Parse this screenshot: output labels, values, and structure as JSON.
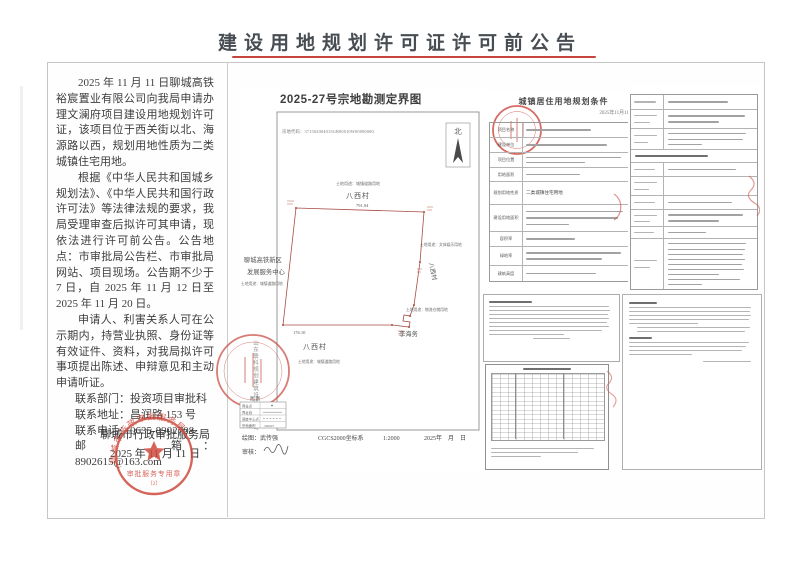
{
  "page": {
    "title": "建设用地规划许可证许可前公告"
  },
  "announcement": {
    "paragraphs": [
      "2025 年 11 月 11 日聊城高铁裕宸置业有限公司向我局申请办理文澜府项目建设用地规划许可证，该项目位于西关街以北、海源路以西，规划用地性质为二类城镇住宅用地。",
      "根据《中华人民共和国城乡规划法》、《中华人民共和国行政许可法》等法律法规的要求，我局受理审查后拟许可其申请，现依法进行许可前公告。公告地点：市审批局公告栏、市审批局网站、项目现场。公告期不少于 7 日，自 2025 年 11 月 12 日至 2025 年 11 月 20 日。",
      "申请人、利害关系人可在公示期内，持营业执照、身份证等有效证件、资料，对我局拟许可事项提出陈述、申辩意见和主动申请听证。"
    ],
    "contact": [
      "联系部门：投资项目审批科",
      "联系地址：昌润路 153 号",
      "联系电话：0635-8902708",
      "邮　　箱：8902615@163.com"
    ],
    "signoff": {
      "org": "聊城市行政审批服务局",
      "date": "2025 年 11 月 11 日"
    },
    "seal": {
      "arc": "聊城市行政审批服务局",
      "label": "审批服务专用章",
      "number": "（2）"
    }
  },
  "survey_map": {
    "title": "2025-27号宗地勘测定界图",
    "parcel_code": "宗地代码：371502004015GB00010W00000000",
    "north": "北",
    "labels": {
      "landuse_north": "土地用途：城镇道路用地",
      "village_north": "八西村",
      "edge_north": "791.04",
      "org_west_1": "聊城高铁新区",
      "org_west_2": "发展服务中心",
      "landuse_west": "土地用途：城镇道路用地",
      "landuse_east": "土地用途：文体娱乐用地",
      "village_east": "八西村",
      "landuse_southeast": "土地用途：物流仓储用地",
      "neighbor_southeast": "李海务",
      "edge_south": "176.10",
      "village_south": "八西村",
      "landuse_south": "土地用途：城镇道路用地"
    },
    "legend": {
      "title": "图 例",
      "row1": "界址点",
      "row2": "界址线",
      "row3": "调查中心点",
      "row4": "宗地面积",
      "row4_value": "320647"
    },
    "surveyor": "山东联科规划建筑设计有限公司",
    "footer": {
      "drawn_by": "绘图：武传强",
      "crs": "CGCS2000坐标系",
      "scale": "1:2000",
      "date": "2025年　月　日",
      "checked_by": "审核："
    }
  },
  "conditions_doc": {
    "title": "城镇居住用地规划条件",
    "date": "2025年11月11日",
    "rows": [
      {
        "label": "项目名称"
      },
      {
        "label": "建设单位"
      },
      {
        "label": "项目位置"
      },
      {
        "label": "用地面积"
      },
      {
        "label": "规划用地性质",
        "value": "二类城镇住宅用地"
      },
      {
        "label": "建设用地面积"
      },
      {
        "label": "容积率"
      },
      {
        "label": "绿地率"
      },
      {
        "label": "建筑高度"
      }
    ]
  }
}
